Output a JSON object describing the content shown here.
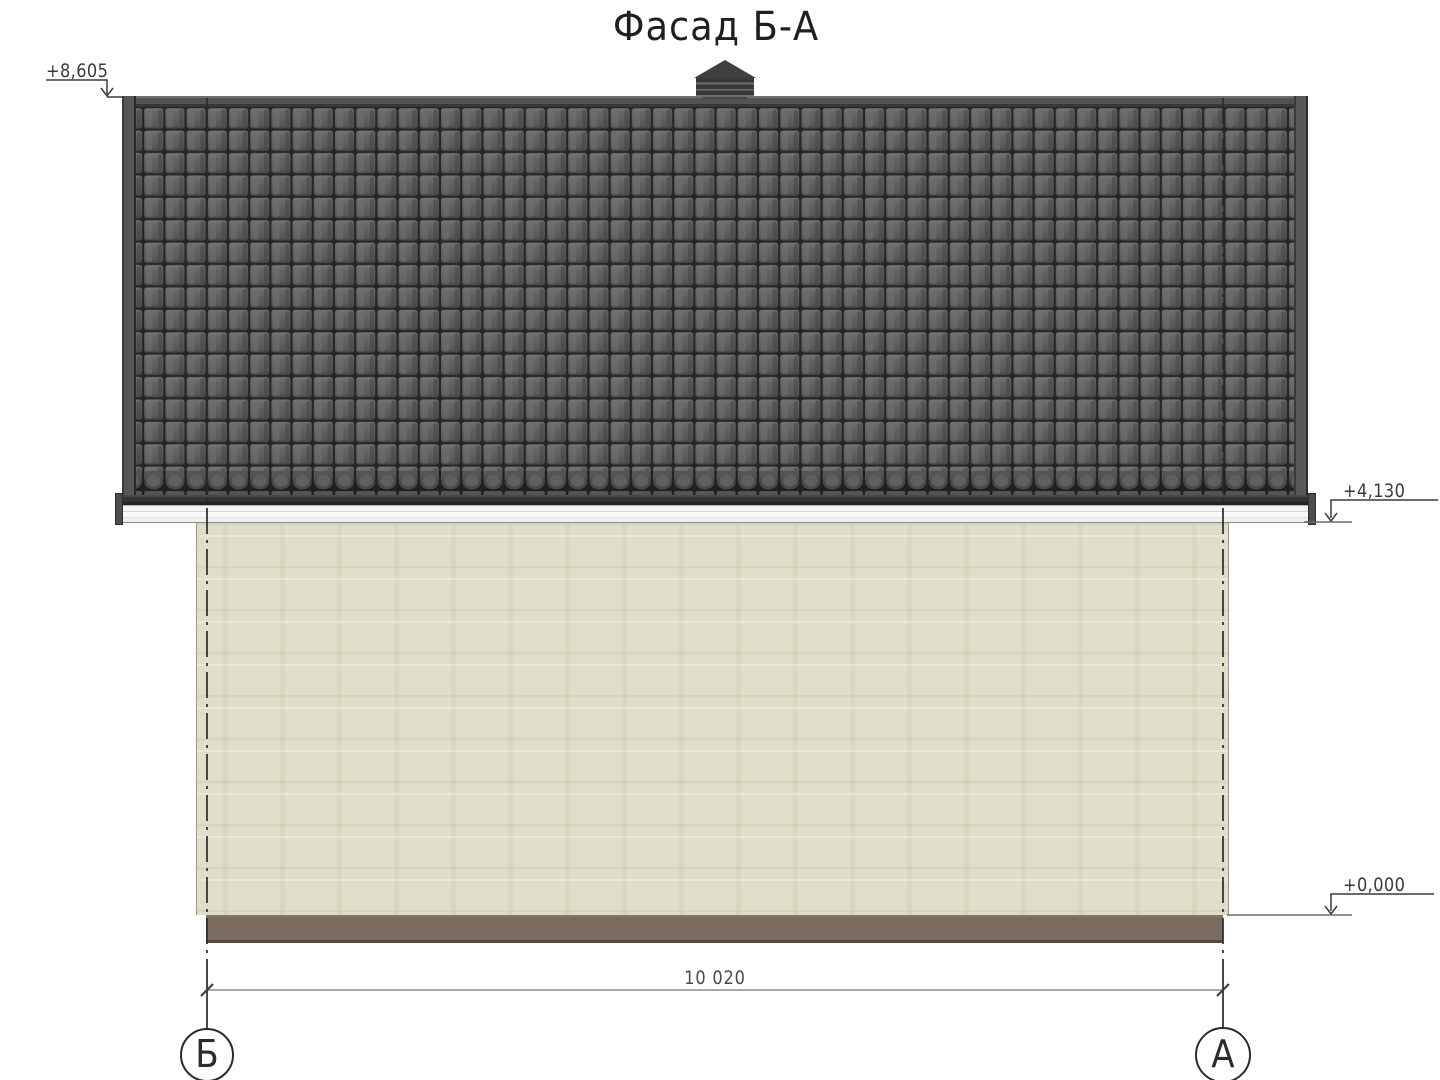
{
  "drawing": {
    "title": "Фасад Б-А",
    "marks": {
      "ridge": {
        "label": "+8,605"
      },
      "eaves": {
        "label": "+4,130"
      },
      "ground": {
        "label": "+0,000"
      }
    },
    "dimensions": {
      "overall_width": "10 020"
    },
    "axes": {
      "left": {
        "label": "Б"
      },
      "right": {
        "label": "А"
      }
    },
    "colors": {
      "roof_tile": "#5e5e5e",
      "roof_tile_gap": "#262626",
      "ridge_cap": "#4e4e4e",
      "wall": "#dfdec8",
      "plinth": "#7b6c5f",
      "gutter": "#343434",
      "fascia": "#f0f0f0",
      "annotation_line": "#333333"
    }
  }
}
